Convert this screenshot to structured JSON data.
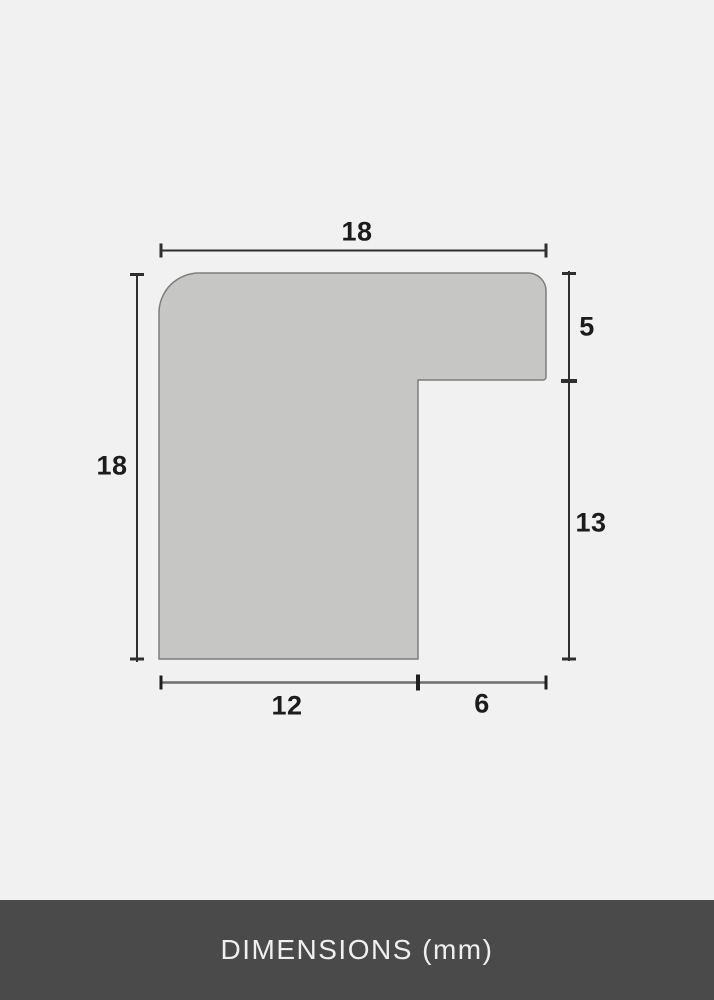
{
  "diagram": {
    "dimension_labels": {
      "top_width": "18",
      "left_height": "18",
      "right_upper": "5",
      "right_lower": "13",
      "bottom_inner": "12",
      "bottom_rabbet": "6"
    },
    "colors": {
      "background": "#f1f1f1",
      "shape_fill": "#c6c6c5",
      "shape_border": "#7d7d7d",
      "dimension_line_dark": "#2f2f2f",
      "dimension_line_light": "#6e6e6e",
      "tick": "#1f1f1f",
      "label_text": "#1c1c1c",
      "footer_background": "#4a4a4b",
      "footer_text": "#efefef"
    }
  },
  "footer": {
    "title": "DIMENSIONS (mm)"
  }
}
